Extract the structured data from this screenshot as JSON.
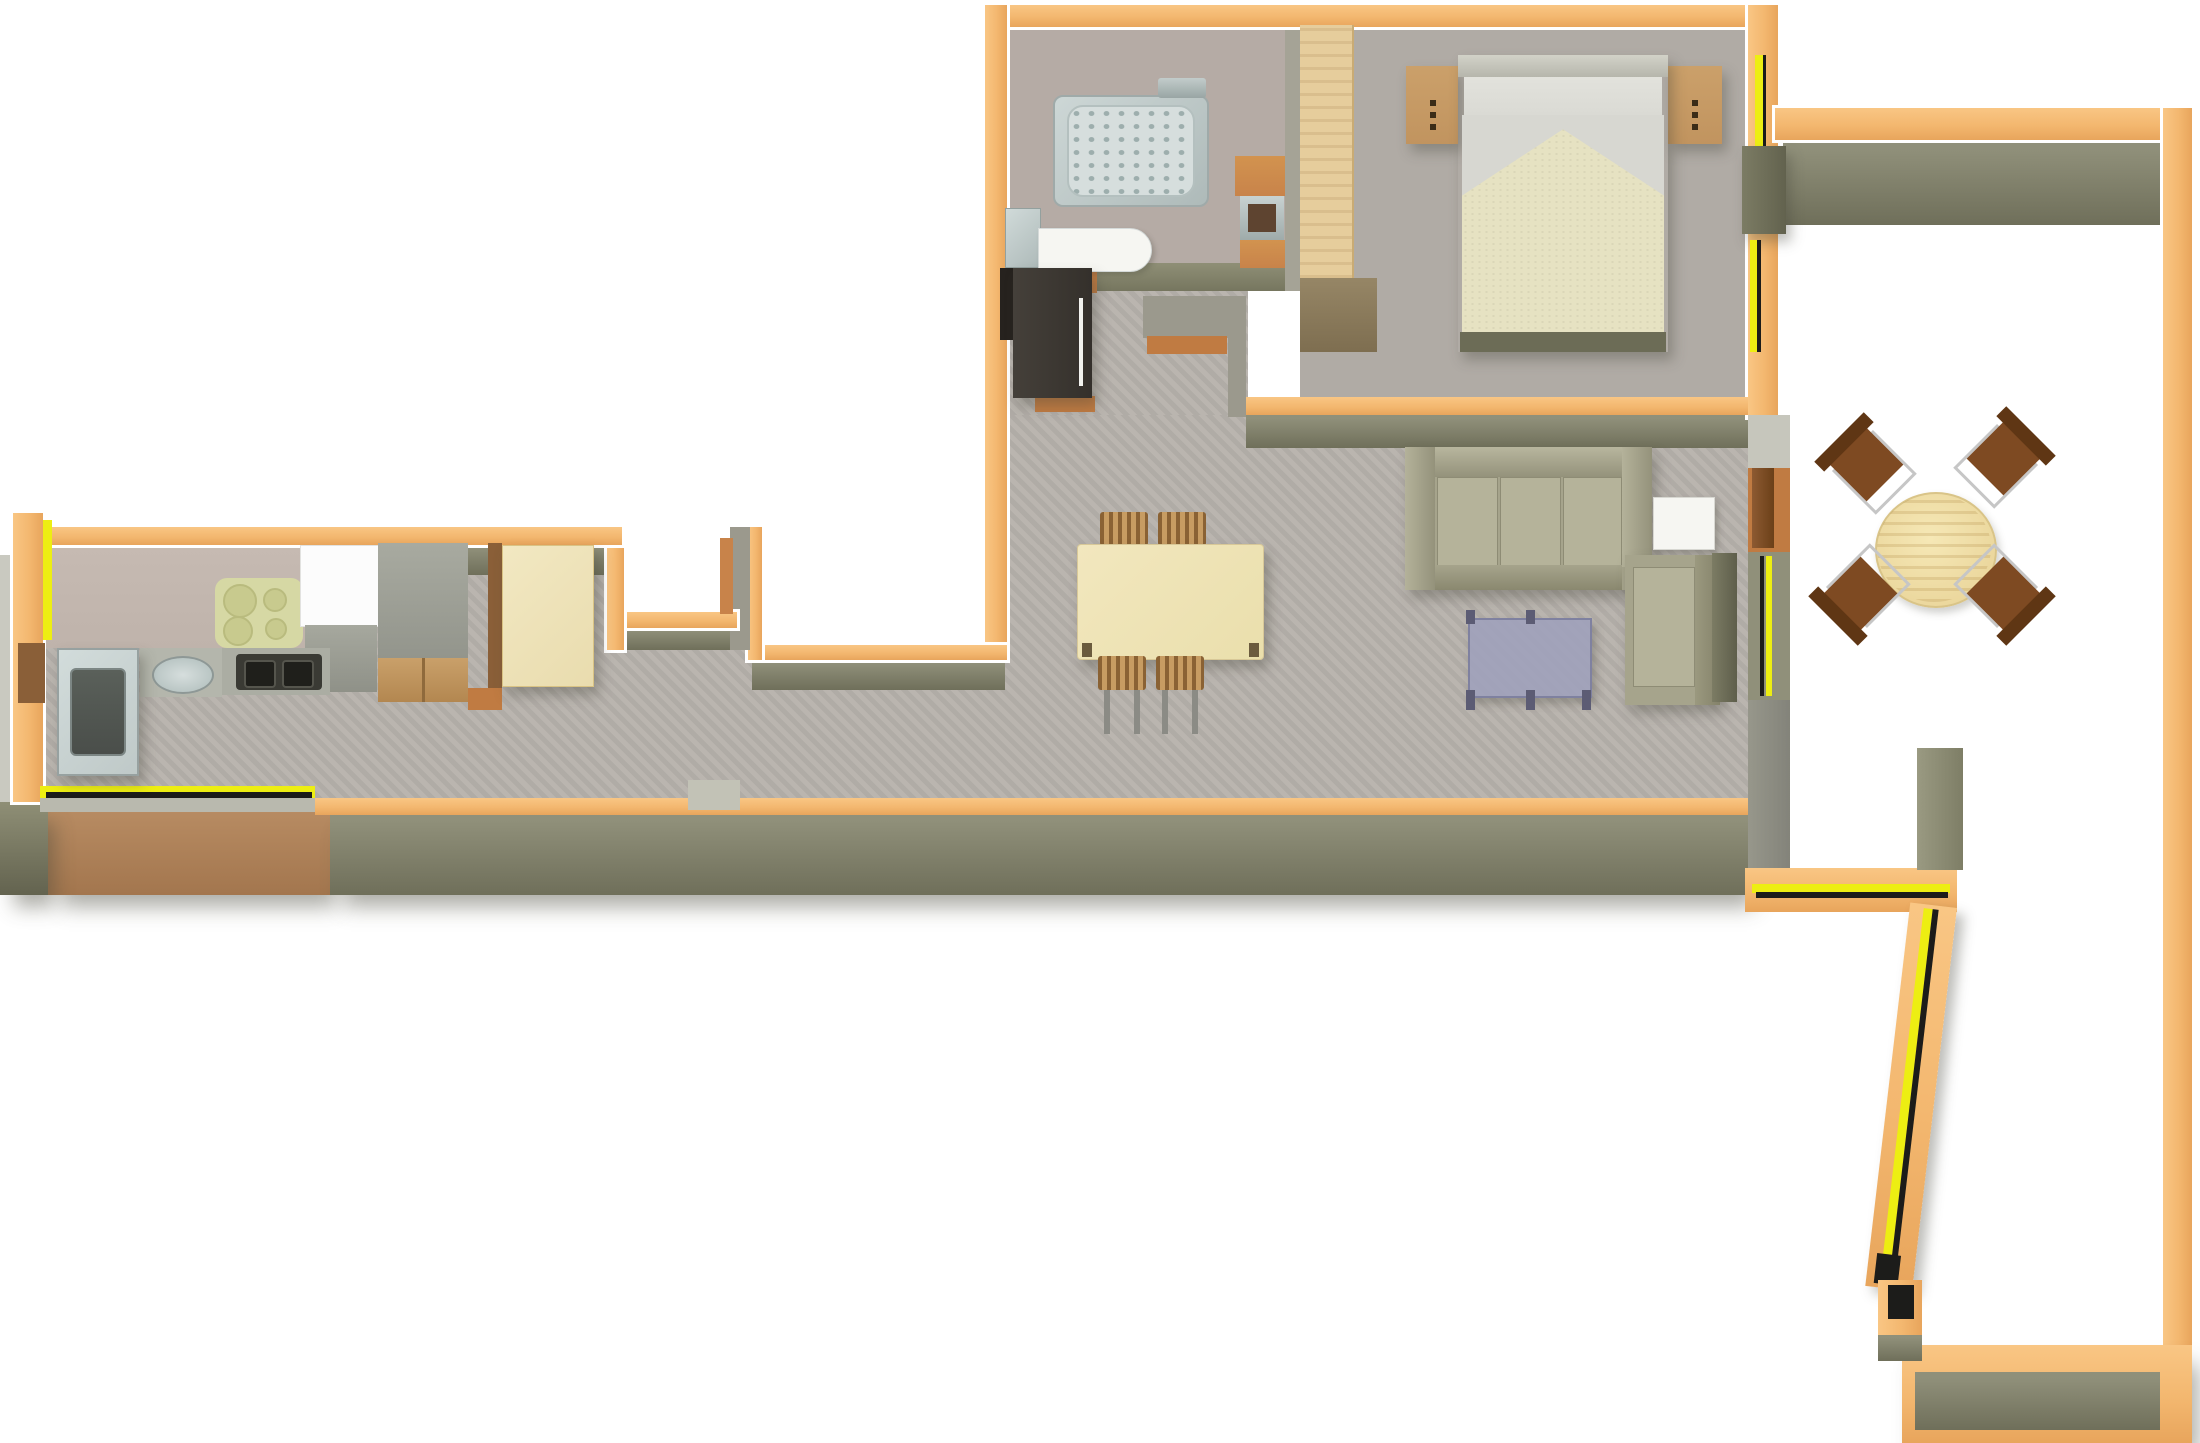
{
  "colors": {
    "bg": "#FFFFFF",
    "wall-orange": "#F3B76F",
    "window-yellow": "#EDEE12",
    "window-black": "#1C1C1A",
    "wall-face": "#90907A",
    "wall-face-dark": "#6F6F5A",
    "wall-face-brown": "#B0845C",
    "wall-grey": "#9B998D",
    "floor": "#B6B1AB",
    "bath-floor": "#B5ABA5",
    "bed-floor": "#B0ABA5",
    "wood-light": "#E9DCAE",
    "wood-pale": "#EADFAC",
    "wood-mid": "#C1945F",
    "wood-accent": "#C8834A",
    "wood-dark": "#7E4A22",
    "threshold": "#C07B42",
    "steel": "#BFC9C8",
    "steel-dark": "#4A4E4A",
    "appliance-dark": "#34302B",
    "sofa": "#A6A48C",
    "sofa-light": "#B5B39A",
    "sofa-dark": "#8E8C75",
    "cream": "#E6E2C2",
    "silver": "#D7D7D1",
    "coffee-table": "#9EA0BC",
    "white-furniture": "#F6F6F2",
    "hob-mat": "#D6D8A4",
    "counter-pink": "#BFB3AB",
    "shower-dot": "#9DAEAD"
  },
  "scene": {
    "type": "3d-floor-plan",
    "view": "top-down-render",
    "rooms": [
      {
        "name": "bathroom",
        "furniture": [
          "shower-tray",
          "shower-head",
          "washbasin",
          "toilet-cistern",
          "vanity-shelves"
        ]
      },
      {
        "name": "bedroom",
        "furniture": [
          "double-bed",
          "nightstand-left",
          "nightstand-right",
          "wardrobe",
          "terrace-door"
        ]
      },
      {
        "name": "entry-hall",
        "furniture": [
          "dark-door-leaf",
          "thresholds"
        ]
      },
      {
        "name": "living-dining-room",
        "furniture": [
          "sofa",
          "armchair",
          "side-table",
          "coffee-table",
          "tv-column",
          "dining-table",
          "dining-chairs"
        ]
      },
      {
        "name": "kitchen",
        "furniture": [
          "sink-unit",
          "counter-basin",
          "cooktop",
          "hob-mat",
          "fridge",
          "cabinet-column",
          "kitchen-door"
        ]
      },
      {
        "name": "corridor",
        "furniture": []
      },
      {
        "name": "terrace",
        "furniture": [
          "round-table",
          "four-chairs"
        ]
      }
    ]
  }
}
